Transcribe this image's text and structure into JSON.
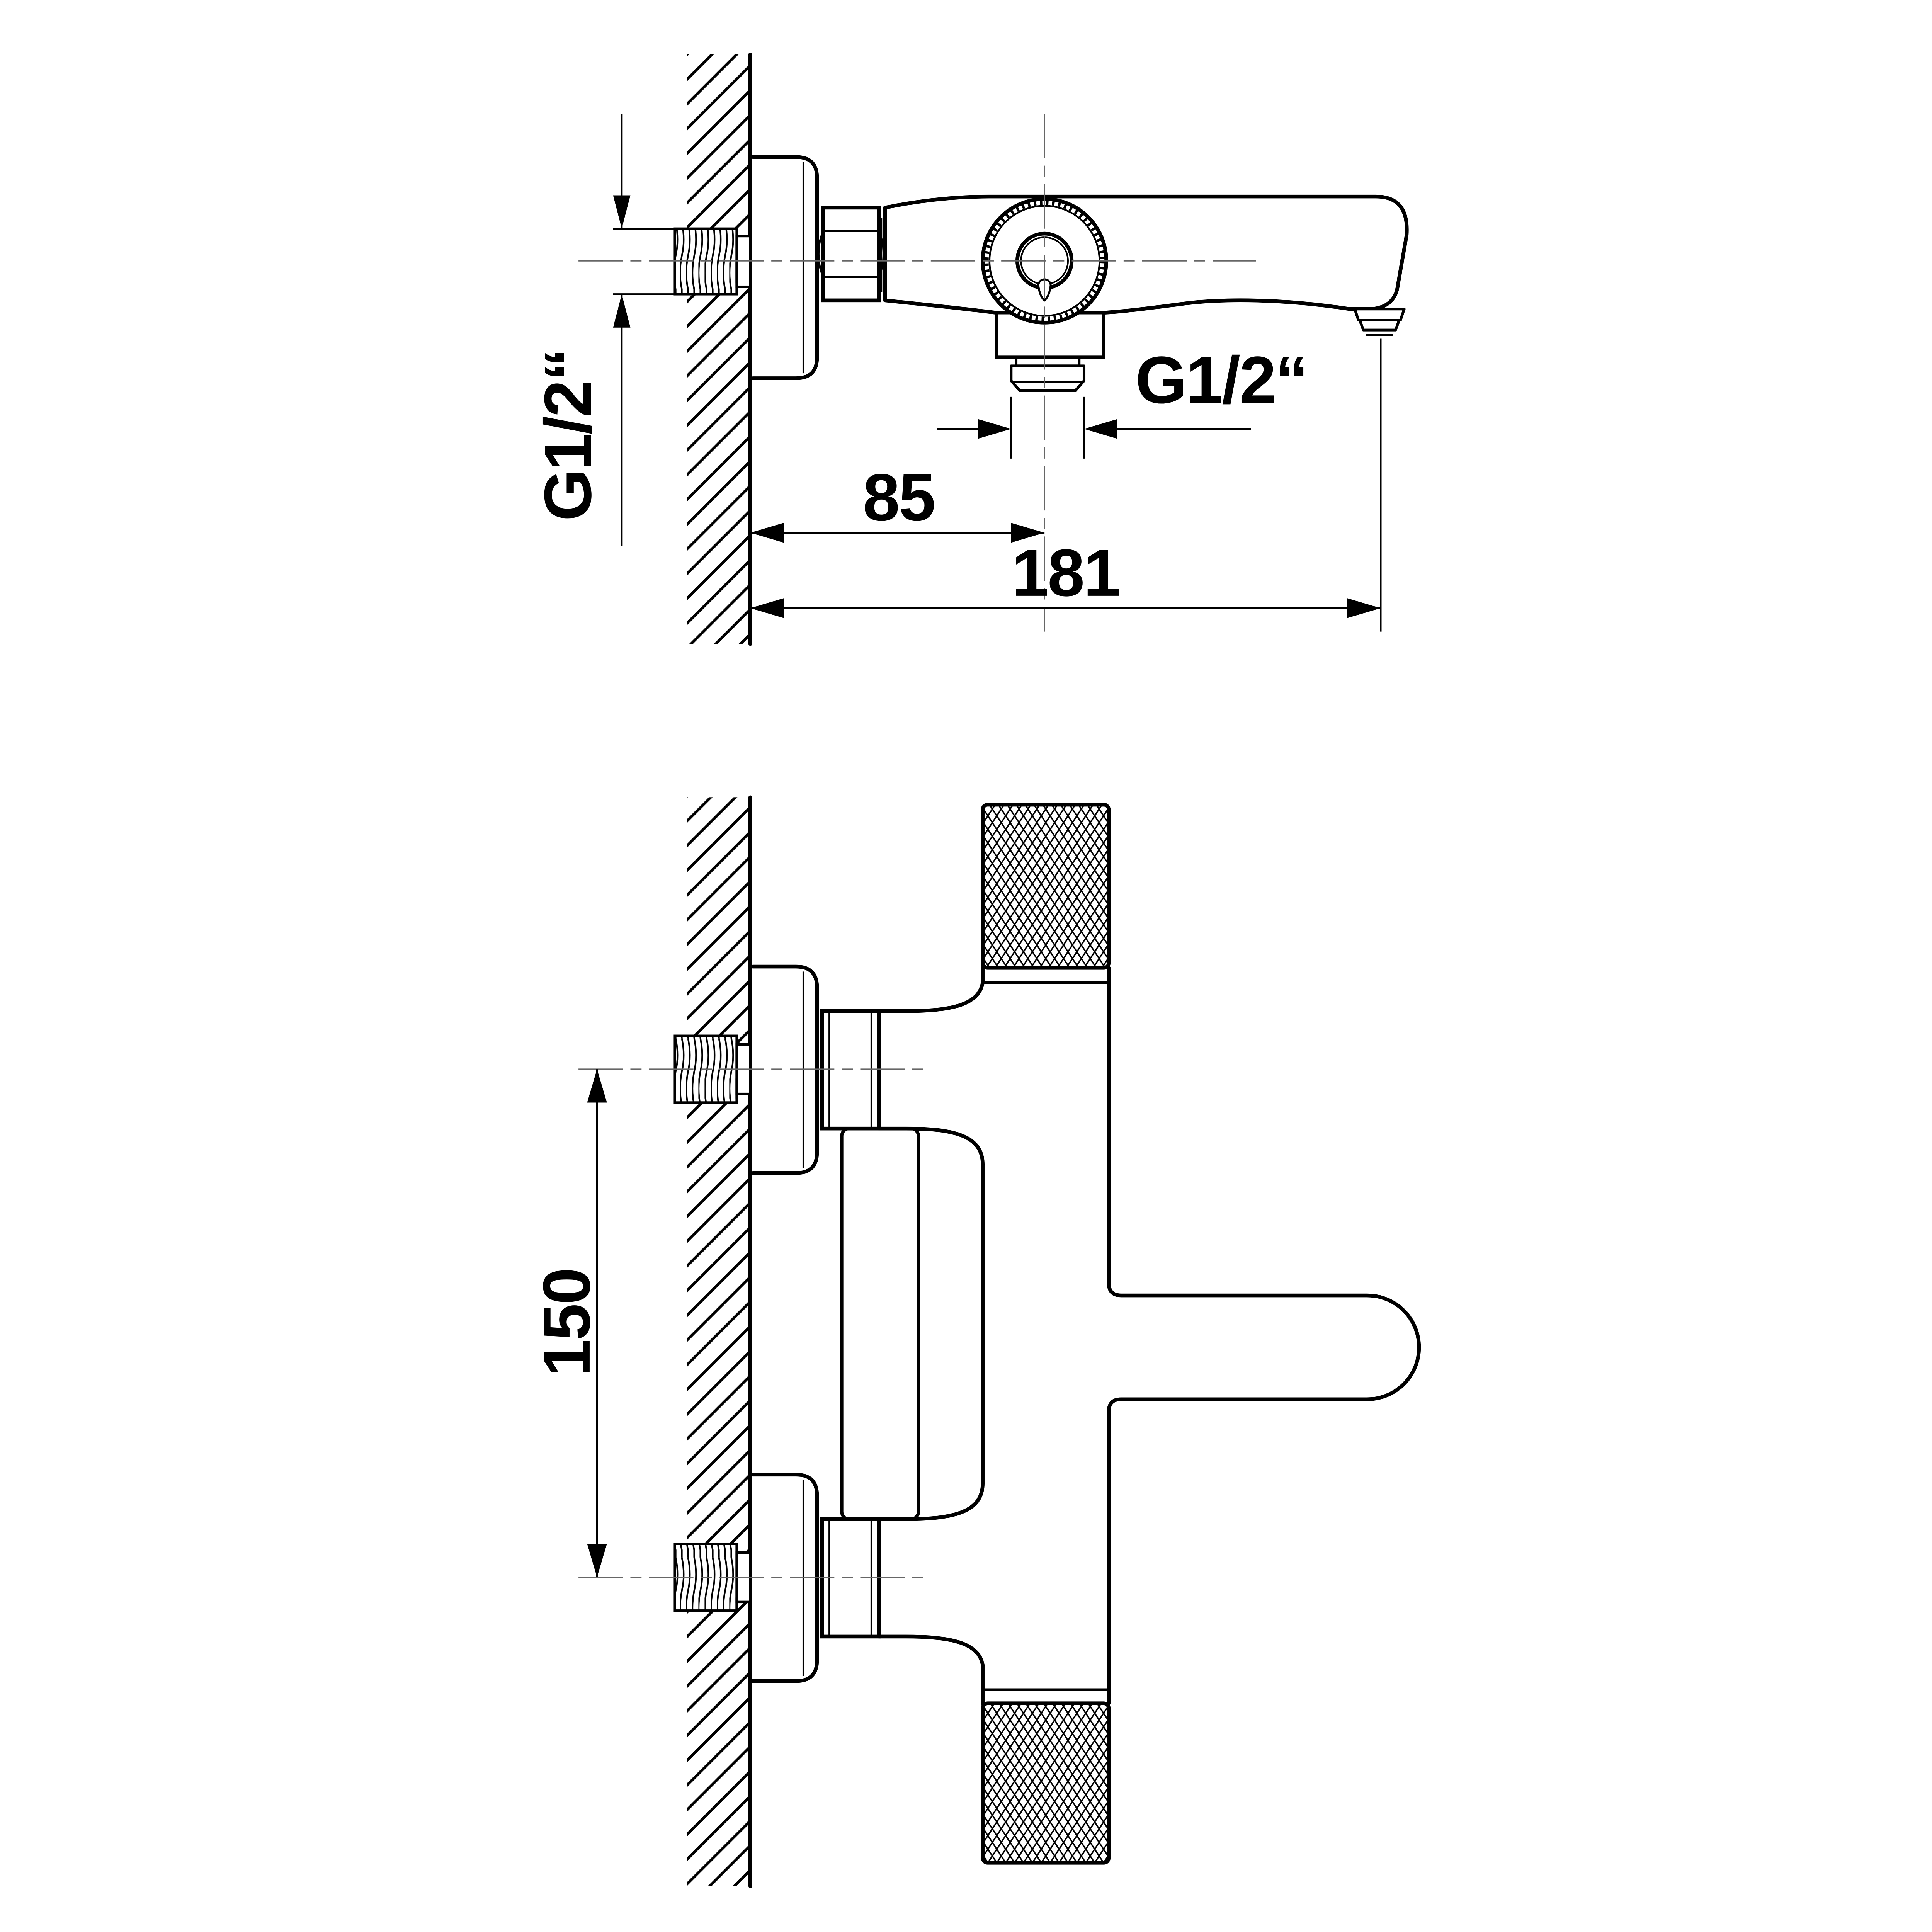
{
  "drawing": {
    "type": "technical-dimension-drawing",
    "subject": "wall-mounted bath/shower mixer tap, two orthographic views",
    "colors": {
      "background": "#ffffff",
      "line": "#000000",
      "centerline": "#666666"
    },
    "top_view": {
      "inlet_thread_label": "G1/2“",
      "outlet_thread_label": "G1/2“",
      "dim_wall_to_outlet_center": "85",
      "dim_wall_to_spout_tip": "181"
    },
    "front_view": {
      "dim_inlet_spacing": "150"
    }
  }
}
